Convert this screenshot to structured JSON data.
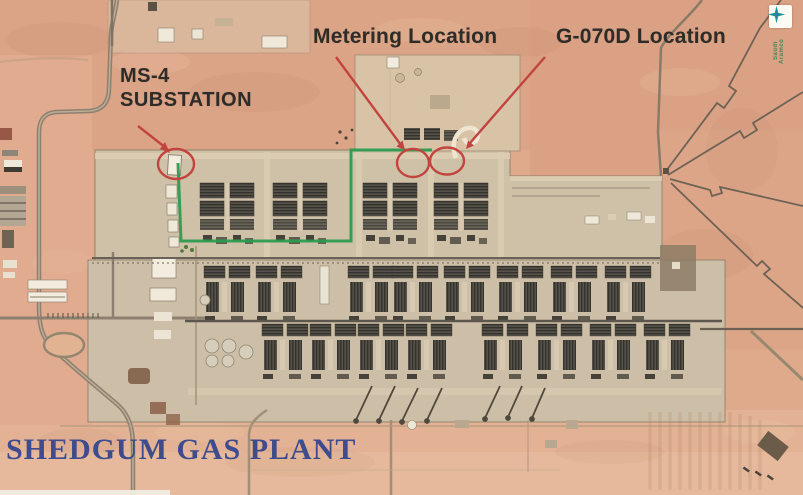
{
  "annotations": {
    "metering_label": "Metering Location",
    "g070d_label": "G-070D Location",
    "ms4_line1": "MS-4",
    "ms4_line2": "SUBSTATION",
    "plant_title": "SHEDGUM GAS PLANT"
  },
  "logo": {
    "name": "saudi-aramco-logo",
    "text": "Saudi Aramco"
  },
  "colors": {
    "marker_red": "#c2443f",
    "route_green": "#2c9b4f",
    "label_text": "#2e2c29",
    "title_blue": "#3e4b8d",
    "desert_tan": "#dfa98c",
    "plant_pad": "#cfc1a8"
  }
}
